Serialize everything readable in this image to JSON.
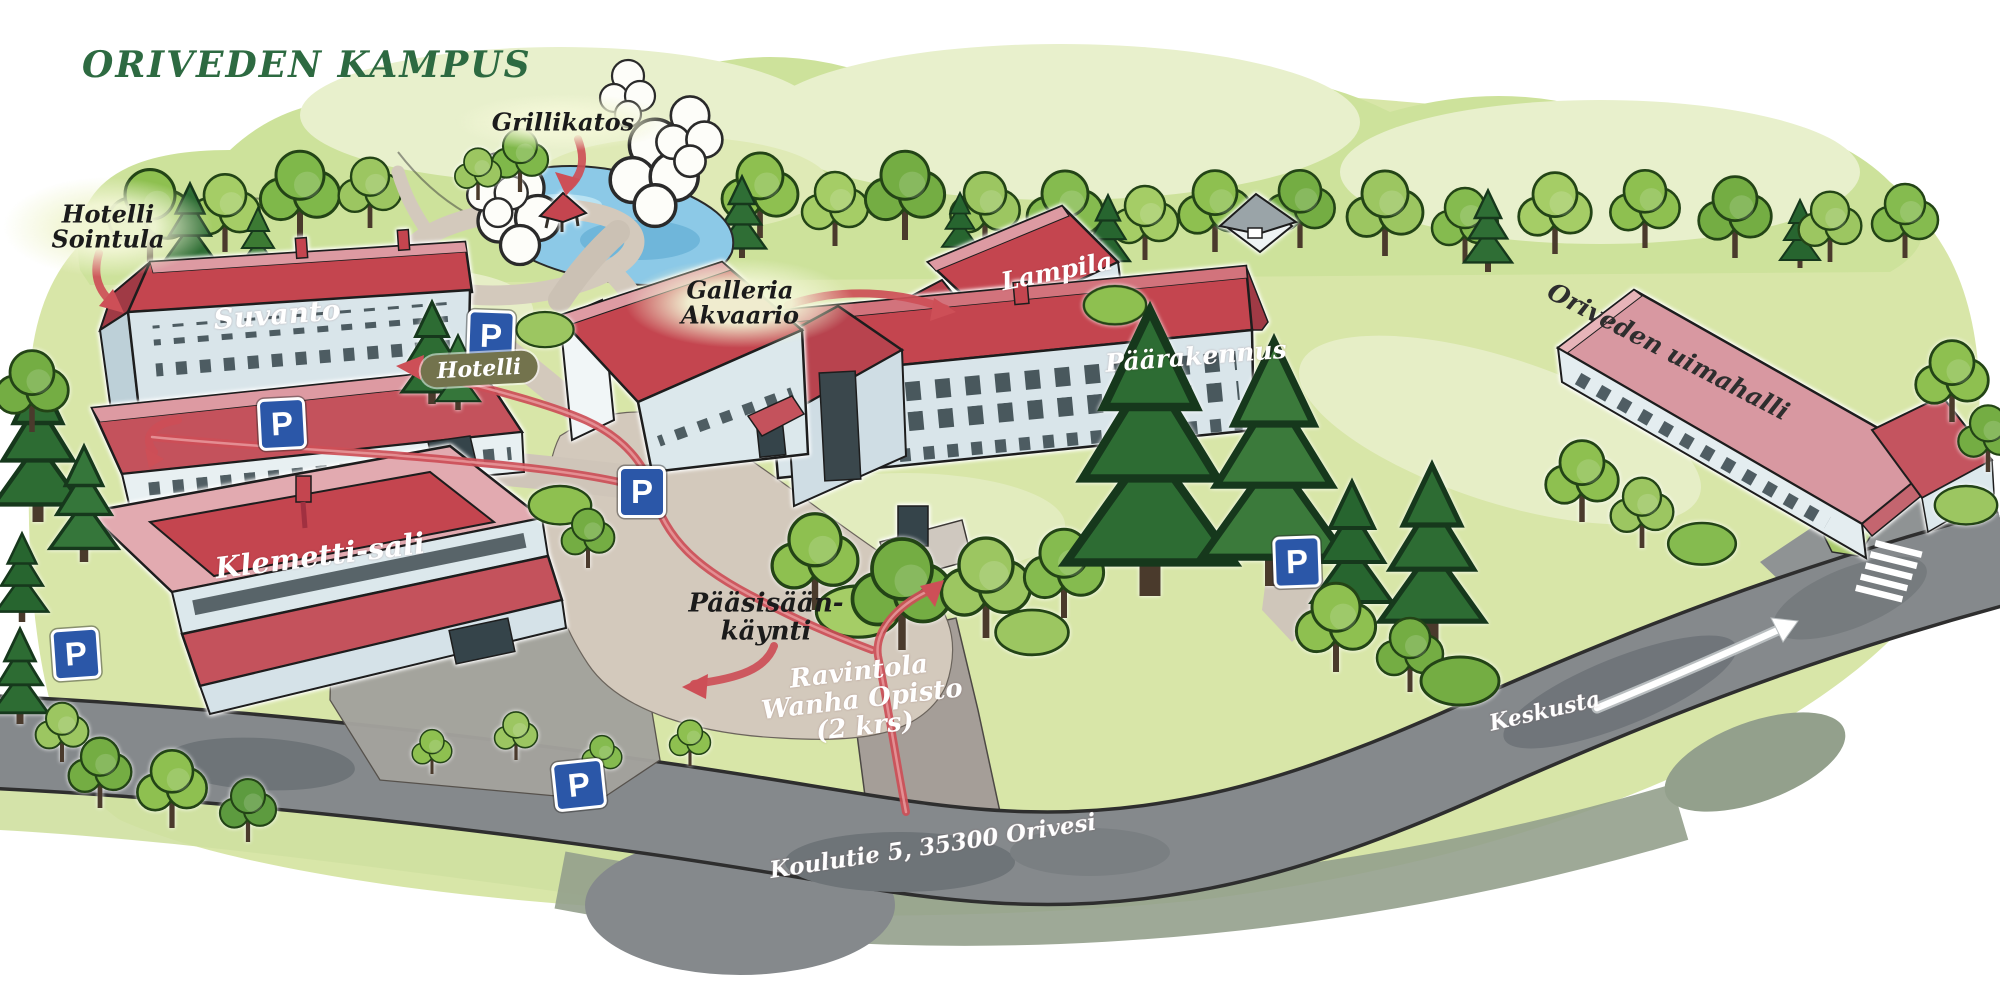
{
  "title": "ORIVEDEN KAMPUS",
  "buildings": {
    "suvanto": "Suvanto",
    "klemetti": "Klemetti-sali",
    "lampila": "Lampila",
    "paarakennus": "Päärakennus",
    "uimahalli": "Oriveden uimahalli"
  },
  "labels": {
    "grillikatos": "Grillikatos",
    "hotelli_sointula": {
      "line1": "Hotelli",
      "line2": "Sointula"
    },
    "hotelli_badge": "Hotelli",
    "galleria": {
      "line1": "Galleria",
      "line2": "Akvaario"
    },
    "paasisaankaynti": {
      "line1": "Pääsisään-",
      "line2": "käynti"
    },
    "ravintola": {
      "line1": "Ravintola",
      "line2": "Wanha Opisto",
      "line3": "(2 krs)"
    },
    "keskusta": "Keskusta",
    "address": "Koulutie 5, 35300 Orivesi"
  },
  "parking": {
    "letter": "P",
    "sign_count": 6
  },
  "colors": {
    "title_green": "#2d6a41",
    "roof_red": "#c4454f",
    "route_red": "#cd4f57",
    "parking_blue": "#2b57a8",
    "road_gray": "#85898c",
    "path_tan": "#d3c9bc",
    "pond_blue": "#8cc9e7",
    "badge_olive": "#73734d"
  }
}
